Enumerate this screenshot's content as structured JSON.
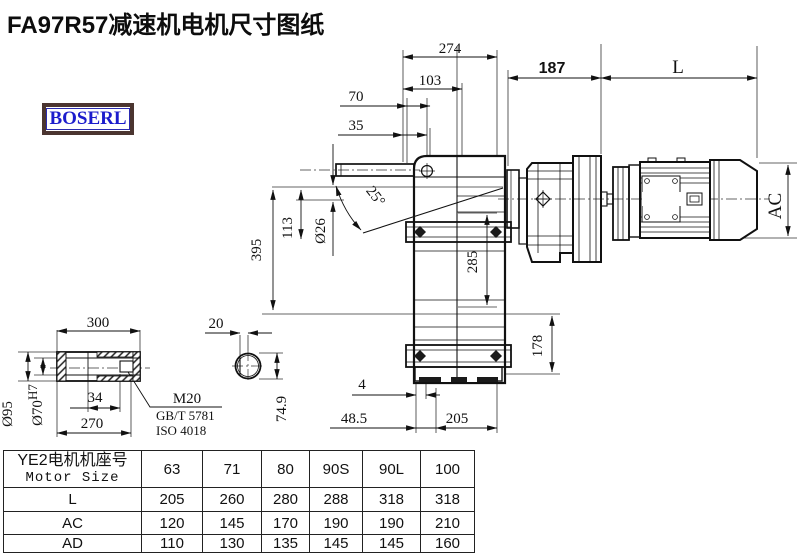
{
  "title": "FA97R57减速机电机尺寸图纸",
  "logo": {
    "text": "BOSERL"
  },
  "drawing": {
    "labels": {
      "d274": "274",
      "d103": "103",
      "d70": "70",
      "d35": "35",
      "d187": "187",
      "dL": "L",
      "dAC": "AC",
      "d395": "395",
      "d113": "113",
      "d26": "Ø26",
      "angle": "25°",
      "d285": "285",
      "d178": "178",
      "d4": "4",
      "d48_5": "48.5",
      "d205": "205"
    },
    "shaft_labels": {
      "d300": "300",
      "d95": "Ø95",
      "d70b": "Ø70",
      "d70b_sup": "H7",
      "d34": "34",
      "d270": "270",
      "m20": "M20",
      "gb": "GB/T 5781",
      "iso": "ISO 4018",
      "d20": "20",
      "d74_9": "74.9"
    }
  },
  "table": {
    "header_cn": "YE2电机机座号",
    "header_en": "Motor Size",
    "sizes": [
      "63",
      "71",
      "80",
      "90S",
      "90L",
      "100"
    ],
    "rows": [
      {
        "label": "L",
        "values": [
          "205",
          "260",
          "280",
          "288",
          "318",
          "318"
        ]
      },
      {
        "label": "AC",
        "values": [
          "120",
          "145",
          "170",
          "190",
          "190",
          "210"
        ]
      },
      {
        "label": "AD",
        "values": [
          "110",
          "130",
          "135",
          "145",
          "145",
          "160"
        ]
      }
    ]
  }
}
